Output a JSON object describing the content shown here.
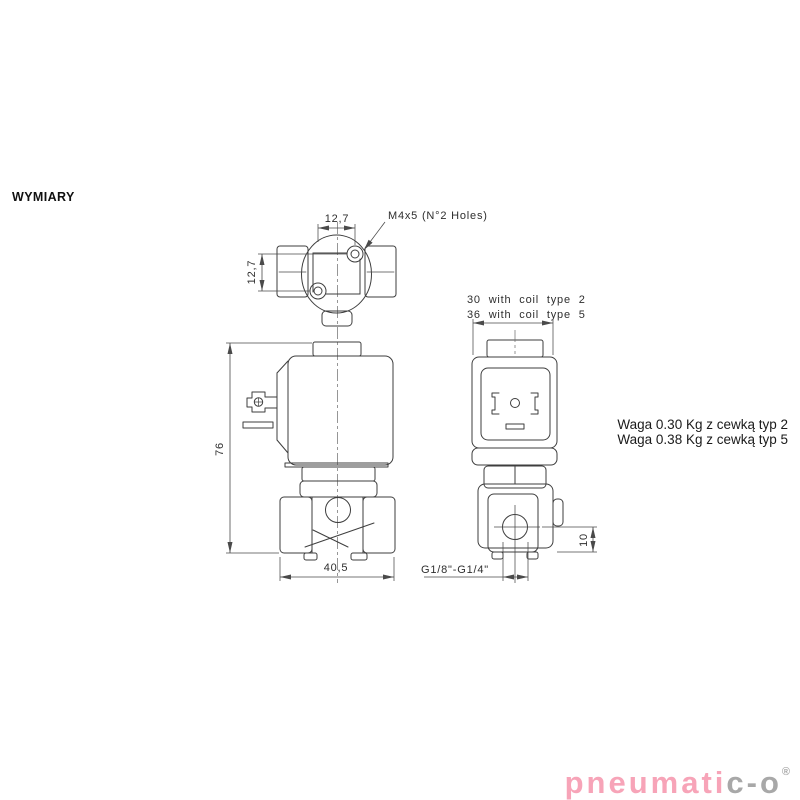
{
  "page": {
    "heading": "WYMIARY"
  },
  "drawing": {
    "line_color": "#3e3e3e",
    "top_view": {
      "dim_hole_spacing_h": "12,7",
      "dim_hole_spacing_v": "12,7",
      "holes_label": "M4x5  (N°2  Holes)"
    },
    "front_view": {
      "dim_height": "76",
      "dim_width": "40,5"
    },
    "side_view": {
      "width_note_line1": "30  with  coil  type  2",
      "width_note_line2": "36  with  coil  type  5",
      "dim_port_to_base": "10",
      "port_thread_label": "G1/8\"-G1/4\""
    }
  },
  "notes": {
    "weight_line1": "Waga 0.30 Kg z cewką typ 2",
    "weight_line2": "Waga 0.38 Kg z cewką typ 5"
  },
  "logo": {
    "text_primary": "pneumati",
    "text_secondary": "c-o",
    "registered_mark": "®",
    "color_primary": "#f7a4b8",
    "color_secondary": "#a8a8a8"
  }
}
